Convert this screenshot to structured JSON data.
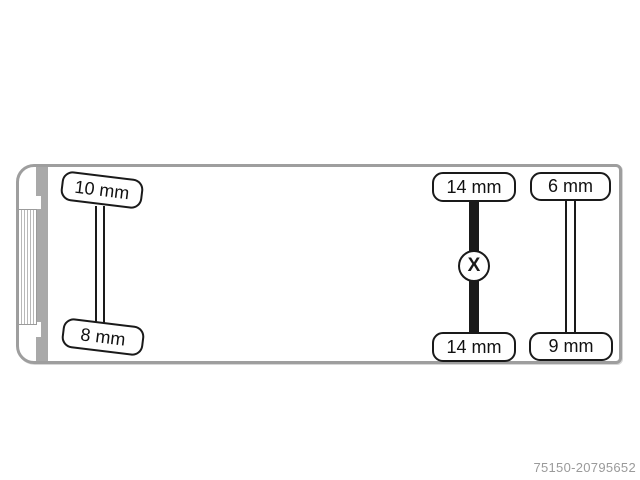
{
  "ref_number": "75150-20795652",
  "colors": {
    "outline": "#9e9e9e",
    "cab_band": "#a9a9a9",
    "axle_black": "#1a1a1a",
    "ref_text": "#9a9a9a"
  },
  "diagram": {
    "axles": [
      {
        "name": "steer-axle",
        "line_style": "double-line",
        "marker": "",
        "tires": [
          {
            "side": "top",
            "label": "10 mm"
          },
          {
            "side": "bottom",
            "label": "8 mm"
          }
        ]
      },
      {
        "name": "drive-axle",
        "line_style": "solid-bar",
        "marker": "X",
        "tires": [
          {
            "side": "top",
            "label": "14 mm"
          },
          {
            "side": "bottom",
            "label": "14 mm"
          }
        ]
      },
      {
        "name": "rear-axle",
        "line_style": "double-line",
        "marker": "",
        "tires": [
          {
            "side": "top",
            "label": "6 mm"
          },
          {
            "side": "bottom",
            "label": "9 mm"
          }
        ]
      }
    ]
  }
}
